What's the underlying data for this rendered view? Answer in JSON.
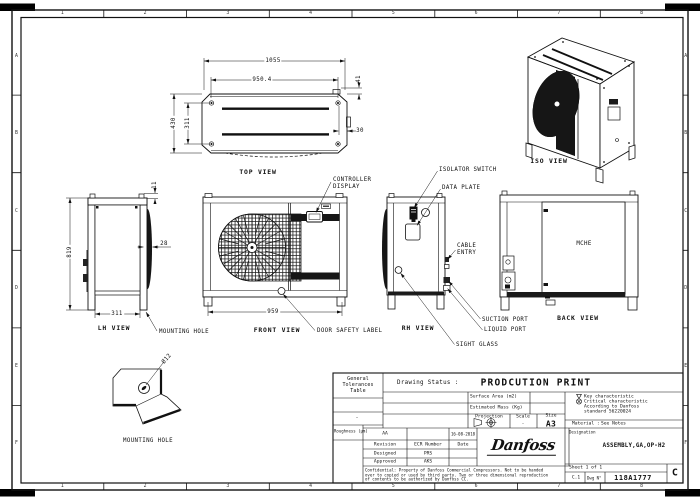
{
  "border": {
    "cols": [
      "1",
      "2",
      "3",
      "4",
      "5",
      "6",
      "7",
      "8"
    ],
    "rows": [
      "A",
      "B",
      "C",
      "D",
      "E",
      "F"
    ]
  },
  "views": {
    "top": {
      "title": "TOP VIEW",
      "dim_width": "1055",
      "dim_inner_width": "950.4",
      "dim_offset": "41",
      "dim_depth": "430",
      "dim_hole_pitch": "311",
      "dim_corner": "30"
    },
    "iso": {
      "title": "ISO VIEW"
    },
    "lh": {
      "title": "LH VIEW",
      "dim_height": "819",
      "dim_width": "311",
      "dim_coil": "28",
      "dim_top": "11",
      "mounting_hole_label": "MOUNTING HOLE"
    },
    "front": {
      "title": "FRONT VIEW",
      "dim_width": "959",
      "controller_label_1": "CONTROLLER",
      "controller_label_2": "DISPLAY",
      "door_label": "DOOR SAFETY LABEL"
    },
    "rh": {
      "title": "RH VIEW",
      "isolator_label": "ISOLATOR SWITCH",
      "data_plate_label": "DATA PLATE",
      "cable_label_1": "CABLE",
      "cable_label_2": "ENTRY",
      "suction_label": "SUCTION PORT",
      "liquid_label": "LIQUID PORT",
      "sight_label": "SIGHT GLASS"
    },
    "back": {
      "title": "BACK VIEW",
      "mche_label": "MCHE"
    },
    "mounting": {
      "title": "MOUNTING HOLE",
      "dim_hole": "Ø12"
    }
  },
  "title_block": {
    "tolerances": {
      "line1": "General",
      "line2": "Tolerances",
      "line3": "Table",
      "dash": "-",
      "roughness": "Roughness (μm)"
    },
    "status": {
      "label": "Drawing Status :",
      "value": "PRODCUTION PRINT"
    },
    "fields": {
      "surface_area": "Surface Area (m2)",
      "estimated_mass": "Estimated Mass (Kg)",
      "projection": "Projection",
      "scale_label": "Scale",
      "scale_value": "-",
      "size_label": "Size",
      "size_value": "A3"
    },
    "revision_table": {
      "current_rev": "AA",
      "current_date": "16-08-2018",
      "revision_h": "Revision",
      "ecr_h": "ECR Number",
      "date_h": "Date",
      "designed_label": "Designed",
      "designed": "PRS",
      "approved_label": "Approved",
      "approved": "AKS"
    },
    "key_char": {
      "line1": "Key characteristic",
      "line2": "Critical characteristic",
      "line3": "According to Danfoss",
      "line4": "standard 56220024"
    },
    "material": {
      "label": "Material :",
      "value": "See Notes"
    },
    "designation": {
      "label": "Designation",
      "value": "ASSEMBLY,GA,OP-H2"
    },
    "logo": "Danfoss",
    "confidential": {
      "line1": "Confidential: Property of Danfoss Commercial Compressors. Not to be handed",
      "line2": "over to copied or used by third party. Two or three dimensional reproduction",
      "line3": "of contents to be authorized by Danfoss CC."
    },
    "sheet": "Sheet 1 of 1",
    "format_ref": "C.1",
    "dwg_label": "Dwg N°",
    "dwg_number": "118A1777",
    "revision": "C"
  }
}
